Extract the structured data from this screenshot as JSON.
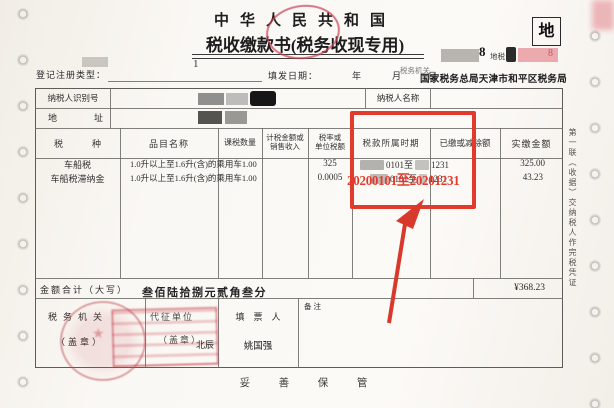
{
  "page": {
    "title_line1": "中华人民共和国",
    "title_line2": "税收缴款书(税务收现专用)",
    "corner_tag": "地",
    "corner_digit": "8",
    "corner_code": "地税",
    "corner_digit_faint": "8"
  },
  "meta": {
    "registration_type_label": "登记注册类型：",
    "registration_note": "1",
    "issue_date_label": "填发日期：",
    "date_year": "年",
    "date_month": "月",
    "date_day": "日",
    "tax_authority_label": "税务机关",
    "tax_authority_stamp": "国家税务总局天津市和平区税务局"
  },
  "taxpayer": {
    "id_label": "纳税人识别号",
    "name_label": "纳税人名称",
    "address_label": "地　址"
  },
  "table": {
    "col_tax_type": "税　种",
    "col_item": "品目名称",
    "col_qty": "课税数量",
    "col_base_1": "计税金额或",
    "col_base_2": "销售收入",
    "col_rate_1": "税率或",
    "col_rate_2": "单位税额",
    "col_period": "税款所属时期",
    "col_paid": "已缴或减除额",
    "col_amount": "实缴金额",
    "rows": [
      {
        "tax_type": "车船税",
        "item": "1.0升以上至1.6升(含)的乘用车",
        "qty": "1.00",
        "rate": "325",
        "period_from": "0101至",
        "period_to": "1231",
        "amount": "325.00"
      },
      {
        "tax_type": "车船税滞纳金",
        "item": "1.0升以上至1.6升(含)的乘用车",
        "qty": "1.00",
        "rate": "0.0005",
        "period_from": "0101至",
        "period_to": "1231",
        "amount": "43.23"
      }
    ]
  },
  "totals": {
    "label": "金额合计（大写）",
    "amount_in_words": "叁佰陆拾捌元贰角叁分",
    "amount_numeric": "¥368.23"
  },
  "footer": {
    "tax_office_label": "税务机关",
    "tax_office_seal": "（盖章）",
    "collector_label": "代征单位",
    "collector_seal": "（盖章）",
    "collector_name": "北辰",
    "preparer_label": "填　票　人",
    "preparer_name": "姚国强",
    "remarks_label": "备注",
    "bottom_note": "妥 善 保 管"
  },
  "side": {
    "copy_note": "第一联（收据）交纳税人作完税凭证"
  },
  "annotation": {
    "highlight_text": "20200101至20201231",
    "color": "#e23b2e",
    "stamp_color": "#c14953"
  }
}
